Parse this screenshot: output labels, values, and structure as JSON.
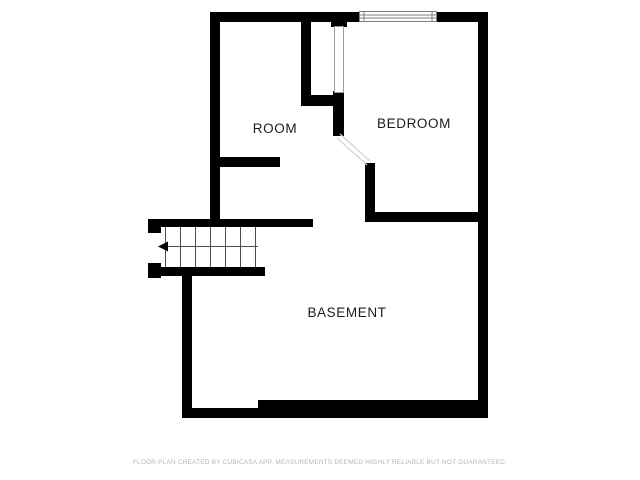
{
  "plan": {
    "rooms": [
      {
        "id": "room",
        "label": "ROOM"
      },
      {
        "id": "bedroom",
        "label": "BEDROOM"
      },
      {
        "id": "basement",
        "label": "BASEMENT"
      }
    ],
    "stairs": {
      "treads": 7,
      "direction": "left",
      "symbol": "walk-line-arrow"
    },
    "features": [
      "window-top",
      "bedroom-door-open",
      "closet-door-opening"
    ],
    "footer": "FLOOR PLAN CREATED BY CUBICASA APP. MEASUREMENTS DEEMED HIGHLY RELIABLE BUT NOT GUARANTEED.",
    "colors": {
      "wall": "#000000",
      "label": "#1c1c1c",
      "footer": "#b5b5b5",
      "stair_line": "#4d4d4d",
      "window_line": "#7f7f7f",
      "door_jamb": "#9a9a9a",
      "door_leaf": "#d4d4d4"
    }
  }
}
